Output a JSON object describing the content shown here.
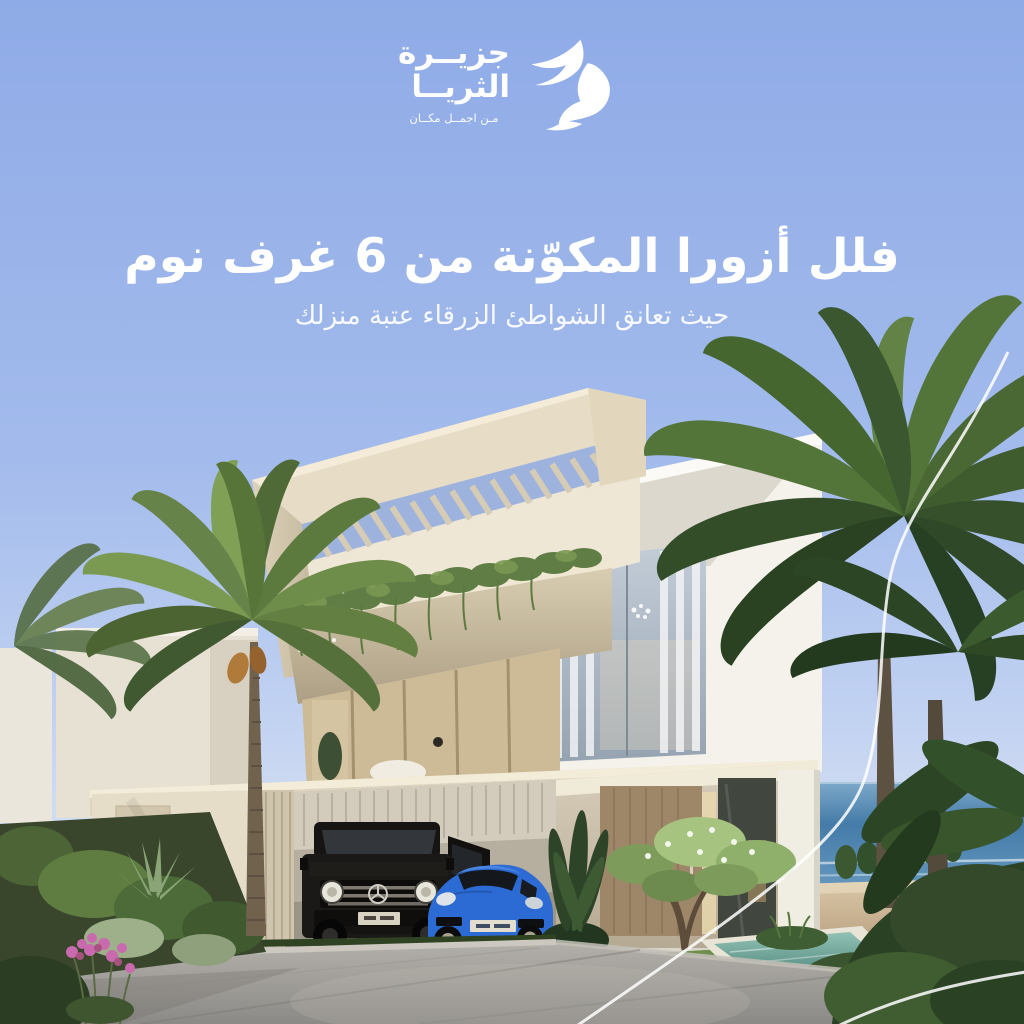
{
  "logo": {
    "brand_line1": "جزيــرة",
    "brand_line2": "الثريــا",
    "tagline": "مـن اجمــل مكــان",
    "icon": "dove-bird-icon"
  },
  "headline": "فلل أزورا المكوّنة من 6 غرف نوم",
  "subheadline": "حيث تعانق الشواطئ الزرقاء عتبة منزلك",
  "scene": {
    "elements": [
      "modern-villa-render",
      "pergola-louver-roof",
      "balcony-hanging-plants",
      "black-mercedes-g-class",
      "blue-porsche-911",
      "entrance-wood-door",
      "reflecting-pool",
      "date-palm-left",
      "palm-cluster-right",
      "sea-horizon",
      "sandy-beach",
      "stone-driveway",
      "pink-flowers",
      "white-swoosh-lines"
    ]
  },
  "colors": {
    "sky_top": "#8fabe7",
    "sky_low": "#d3def3",
    "text": "#ffffff",
    "villa_white": "#f4f2ea",
    "villa_beige": "#e7ddc6",
    "wood_door": "#9e8769",
    "sea": "#4a80ad",
    "sand": "#cdb393",
    "pool_water": "#6fa79b",
    "palm_dark": "#35502b",
    "palm_light": "#74984d",
    "car_black": "#1a1917",
    "car_blue": "#2c6bd4",
    "driveway_gray": "#a5a29d",
    "flower_pink": "#c96aae",
    "swoosh": "#ffffff"
  }
}
